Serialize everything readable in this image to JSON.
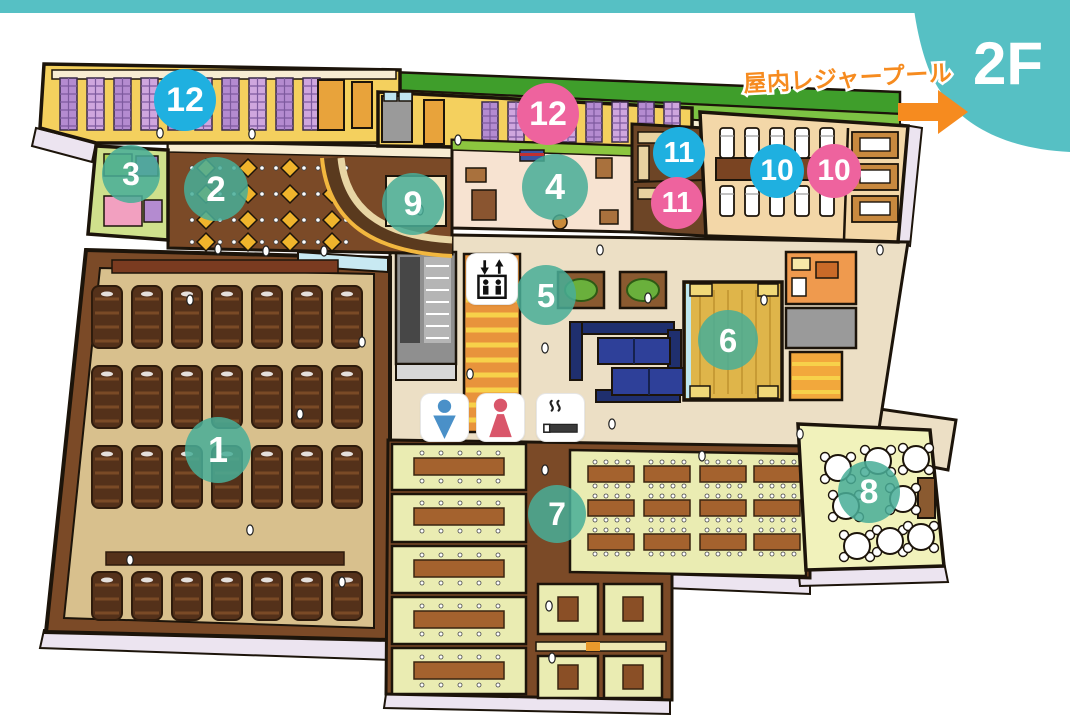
{
  "header": {
    "floor_label": "2F",
    "badge_color": "#56c0c4"
  },
  "pool": {
    "label": "屋内レジャープール",
    "color": "#f68b1f",
    "arrow_icon": "right-arrow"
  },
  "map": {
    "marker_colors": {
      "teal": "rgba(72,174,151,0.86)",
      "blue": "#1fb0e0",
      "pink": "#ee639e"
    },
    "markers": [
      {
        "label": "1",
        "style": "teal",
        "x": 218,
        "y": 450,
        "size": 66
      },
      {
        "label": "2",
        "style": "teal",
        "x": 216,
        "y": 189,
        "size": 64
      },
      {
        "label": "3",
        "style": "teal",
        "x": 131,
        "y": 174,
        "size": 58
      },
      {
        "label": "4",
        "style": "teal",
        "x": 555,
        "y": 187,
        "size": 66
      },
      {
        "label": "5",
        "style": "teal",
        "x": 546,
        "y": 295,
        "size": 60
      },
      {
        "label": "6",
        "style": "teal",
        "x": 728,
        "y": 340,
        "size": 60
      },
      {
        "label": "7",
        "style": "teal",
        "x": 557,
        "y": 514,
        "size": 58
      },
      {
        "label": "8",
        "style": "teal",
        "x": 869,
        "y": 492,
        "size": 62
      },
      {
        "label": "9",
        "style": "teal",
        "x": 413,
        "y": 204,
        "size": 62
      },
      {
        "label": "10",
        "style": "blue",
        "x": 777,
        "y": 171,
        "size": 54
      },
      {
        "label": "10",
        "style": "pink",
        "x": 834,
        "y": 171,
        "size": 54
      },
      {
        "label": "11",
        "style": "blue",
        "x": 679,
        "y": 153,
        "size": 52
      },
      {
        "label": "11",
        "style": "pink",
        "x": 677,
        "y": 203,
        "size": 52
      },
      {
        "label": "12",
        "style": "blue",
        "x": 185,
        "y": 100,
        "size": 62
      },
      {
        "label": "12",
        "style": "pink",
        "x": 548,
        "y": 114,
        "size": 62
      }
    ],
    "icons": [
      {
        "name": "elevator-icon",
        "x": 467,
        "y": 254,
        "size": 50,
        "color": "#111111"
      },
      {
        "name": "mens-restroom-icon",
        "x": 421,
        "y": 394,
        "size": 47,
        "color": "#4a90c8"
      },
      {
        "name": "womens-restroom-icon",
        "x": 477,
        "y": 394,
        "size": 47,
        "color": "#d9566a"
      },
      {
        "name": "smoking-area-icon",
        "x": 537,
        "y": 394,
        "size": 47,
        "color": "#3a3a3a"
      }
    ]
  }
}
